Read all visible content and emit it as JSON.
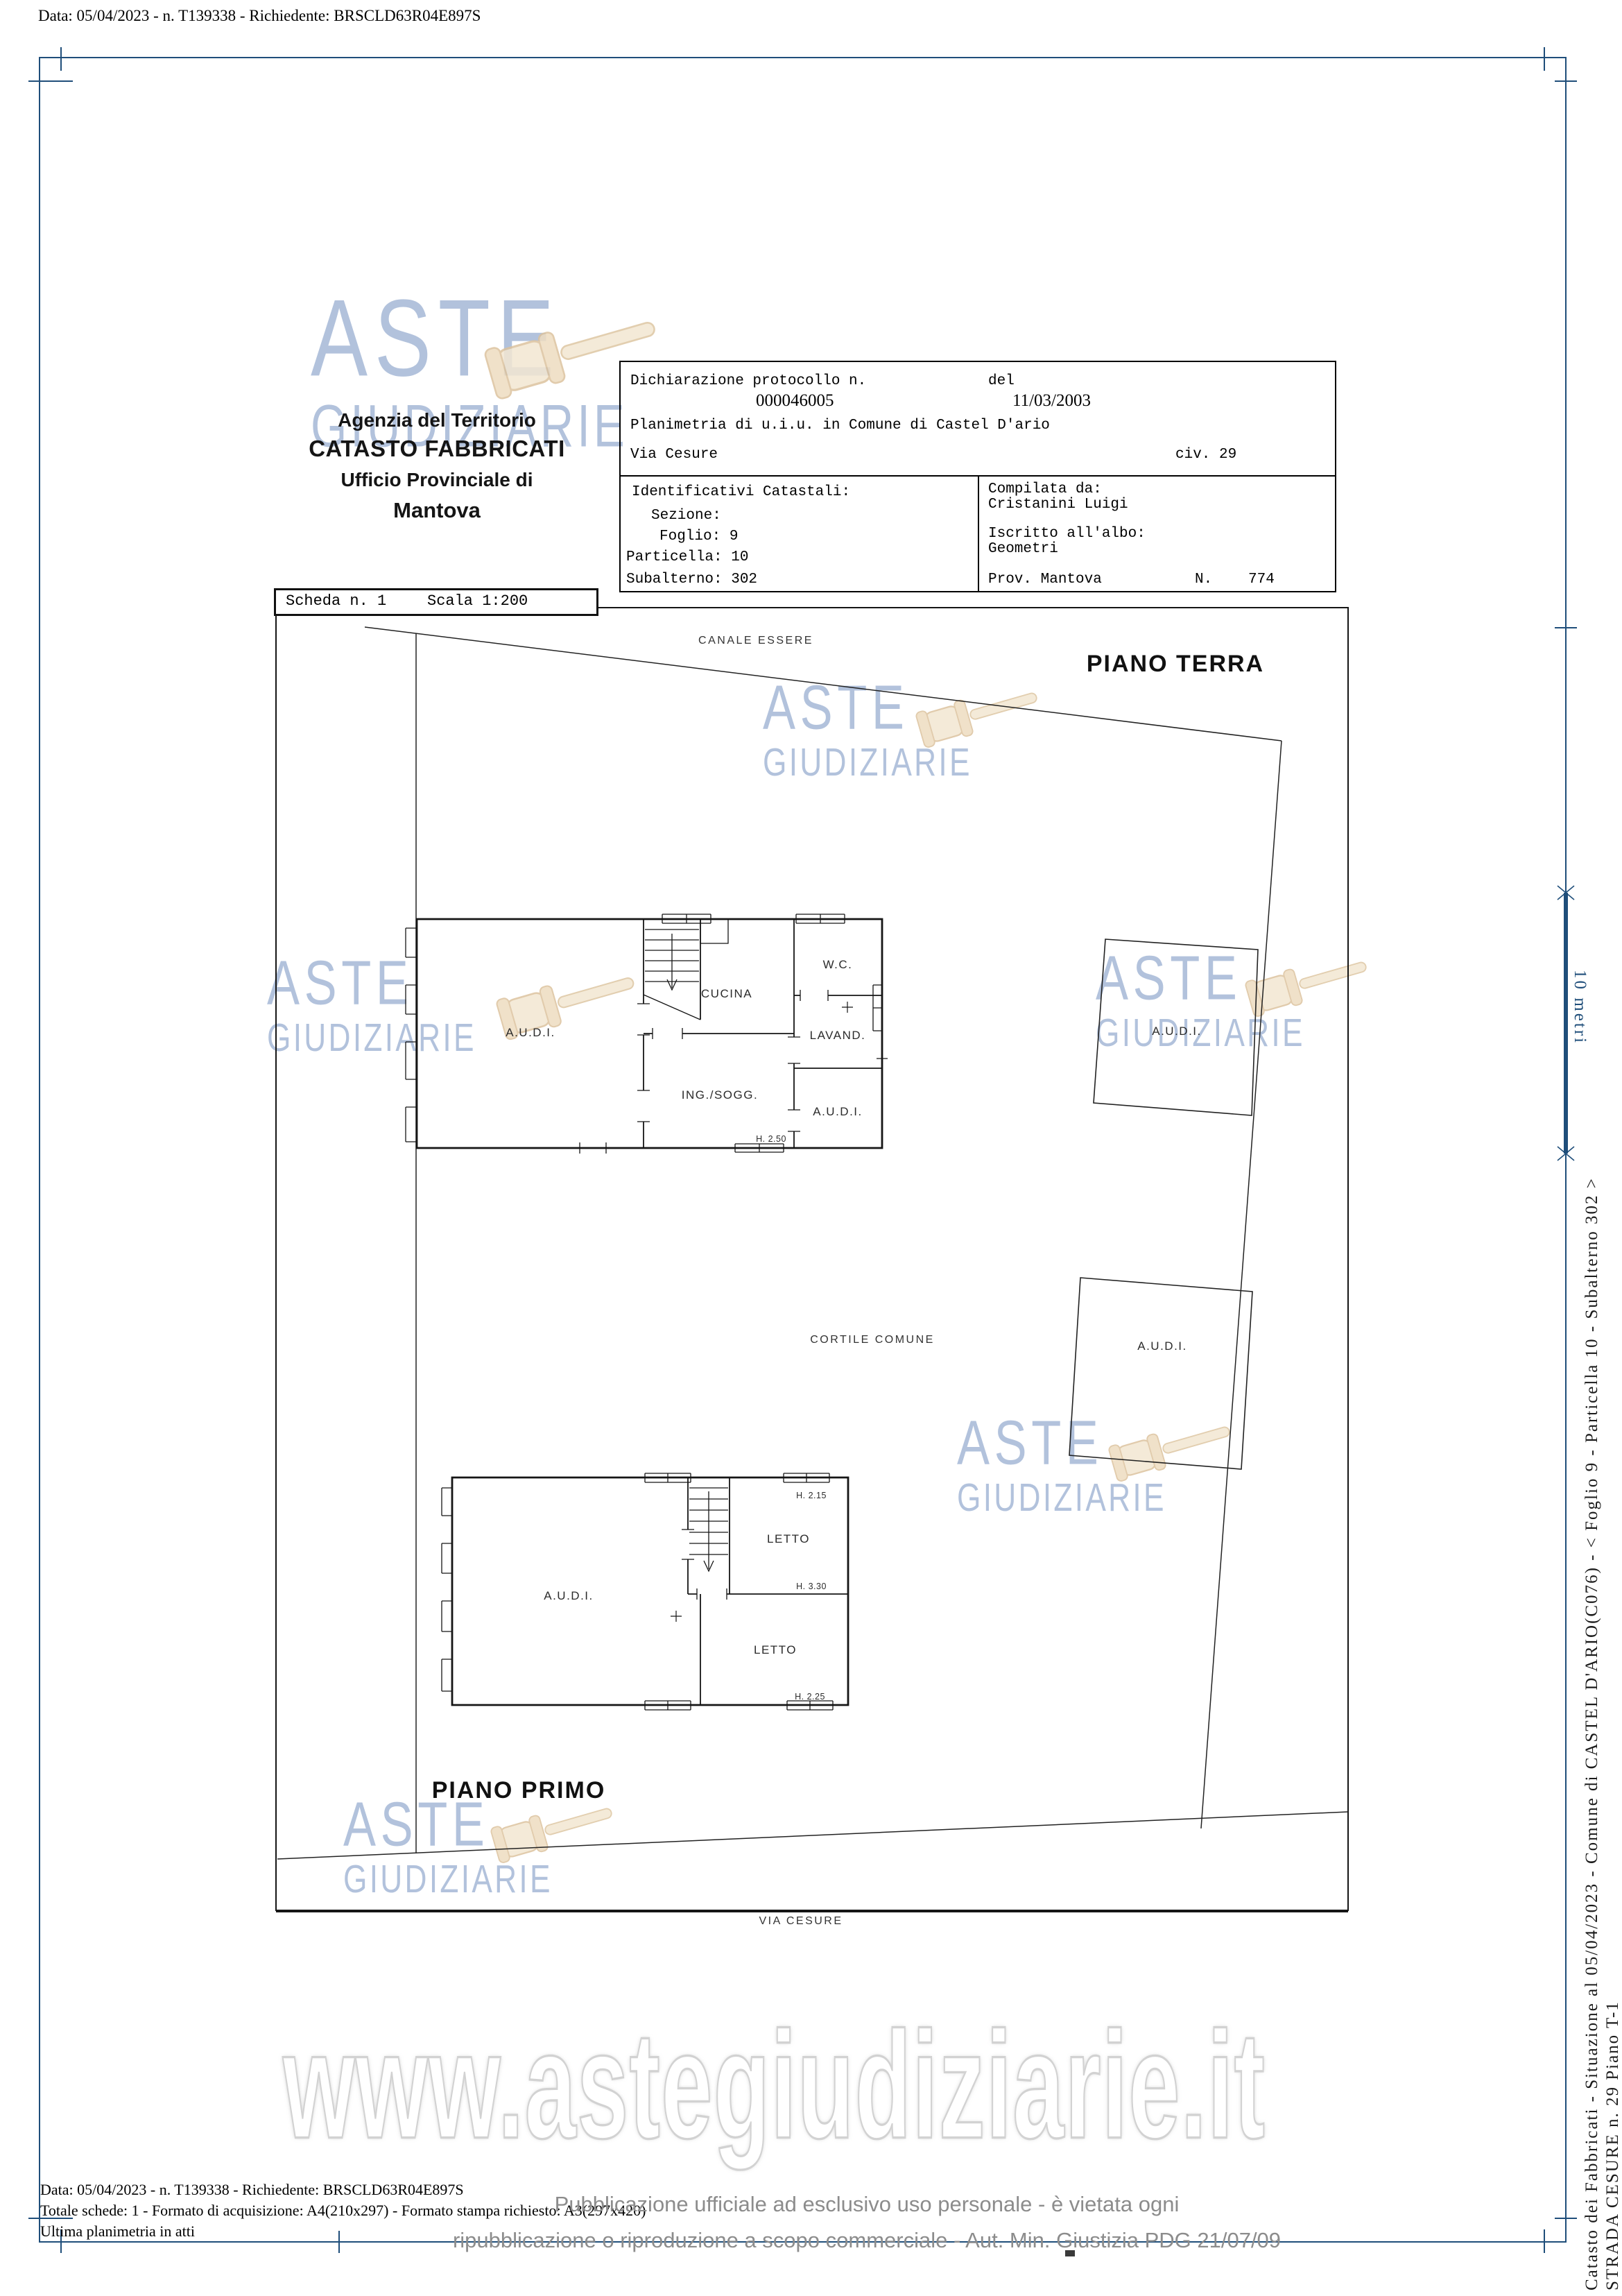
{
  "header": {
    "line": "Data: 05/04/2023 - n. T139338 - Richiedente: BRSCLD63R04E897S"
  },
  "agency": {
    "line1": "Agenzia del Territorio",
    "line2": "CATASTO FABBRICATI",
    "line3": "Ufficio Provinciale di",
    "line4": "Mantova"
  },
  "declaration": {
    "label": "Dichiarazione protocollo n.",
    "protocol_number": "000046005",
    "del_label": "del",
    "date": "11/03/2003",
    "planimetria_line": "Planimetria di u.i.u. in Comune di Castel D'ario",
    "street": "Via Cesure",
    "civ": "civ. 29"
  },
  "identifiers": {
    "title": "Identificativi Catastali:",
    "sezione": "Sezione:",
    "foglio": "Foglio: 9",
    "particella": "Particella: 10",
    "subalterno": "Subalterno: 302"
  },
  "compiler": {
    "compilata_label": "Compilata da:",
    "name": "Cristanini Luigi",
    "albo_label": "Iscritto all'albo:",
    "albo": "Geometri",
    "prov": "Prov. Mantova",
    "n_label": "N.",
    "number": "774"
  },
  "scheda": {
    "scheda_label": "Scheda n. 1",
    "scala_label": "Scala 1:200"
  },
  "plan": {
    "piano_terra": "PIANO TERRA",
    "piano_primo": "PIANO PRIMO",
    "canale": "CANALE ESSERE",
    "cortile": "CORTILE COMUNE",
    "via": "VIA CESURE",
    "ground": {
      "audi_left": "A.U.D.I.",
      "cucina": "CUCINA",
      "wc": "W.C.",
      "lavand": "LAVAND.",
      "ing_sogg": "ING./SOGG.",
      "audi_right": "A.U.D.I.",
      "h250": "H. 2.50"
    },
    "annex": {
      "audi_upper": "A.U.D.I.",
      "audi_lower": "A.U.D.I."
    },
    "first": {
      "audi": "A.U.D.I.",
      "letto_upper": "LETTO",
      "letto_lower": "LETTO",
      "h215": "H. 2.15",
      "h330": "H. 3.30",
      "h225": "H. 2.25"
    }
  },
  "scalebar": {
    "label": "10 metri",
    "color": "#1f4e7a"
  },
  "sidebar": {
    "line1": "Catasto dei Fabbricati - Situazione al 05/04/2023 - Comune di CASTEL D'ARIO(C076) - <  Foglio 9 - Particella  10 - Subalterno 302 >",
    "line2": "STRADA CESURE n. 29 Piano T-1"
  },
  "watermark": {
    "aste": "ASTE",
    "giudiziarie": "GIUDIZIARIE",
    "url": "www.astegiudiziarie.it",
    "blue": "#829cc6",
    "gavel_tan": "#f2e6d0"
  },
  "footer": {
    "line1": "Data: 05/04/2023 - n. T139338 - Richiedente: BRSCLD63R04E897S",
    "line2": "Totale schede: 1 - Formato di acquisizione: A4(210x297)  - Formato stampa richiesto: A3(297x420)",
    "line3": "Ultima planimetria in atti",
    "notice1": "Pubblicazione ufficiale ad esclusivo uso personale - è vietata ogni",
    "notice2": "ripubblicazione o riproduzione a scopo commerciale - Aut. Min. Giustizia PDG 21/07/09"
  },
  "frame": {
    "color": "#1f4e7a"
  }
}
